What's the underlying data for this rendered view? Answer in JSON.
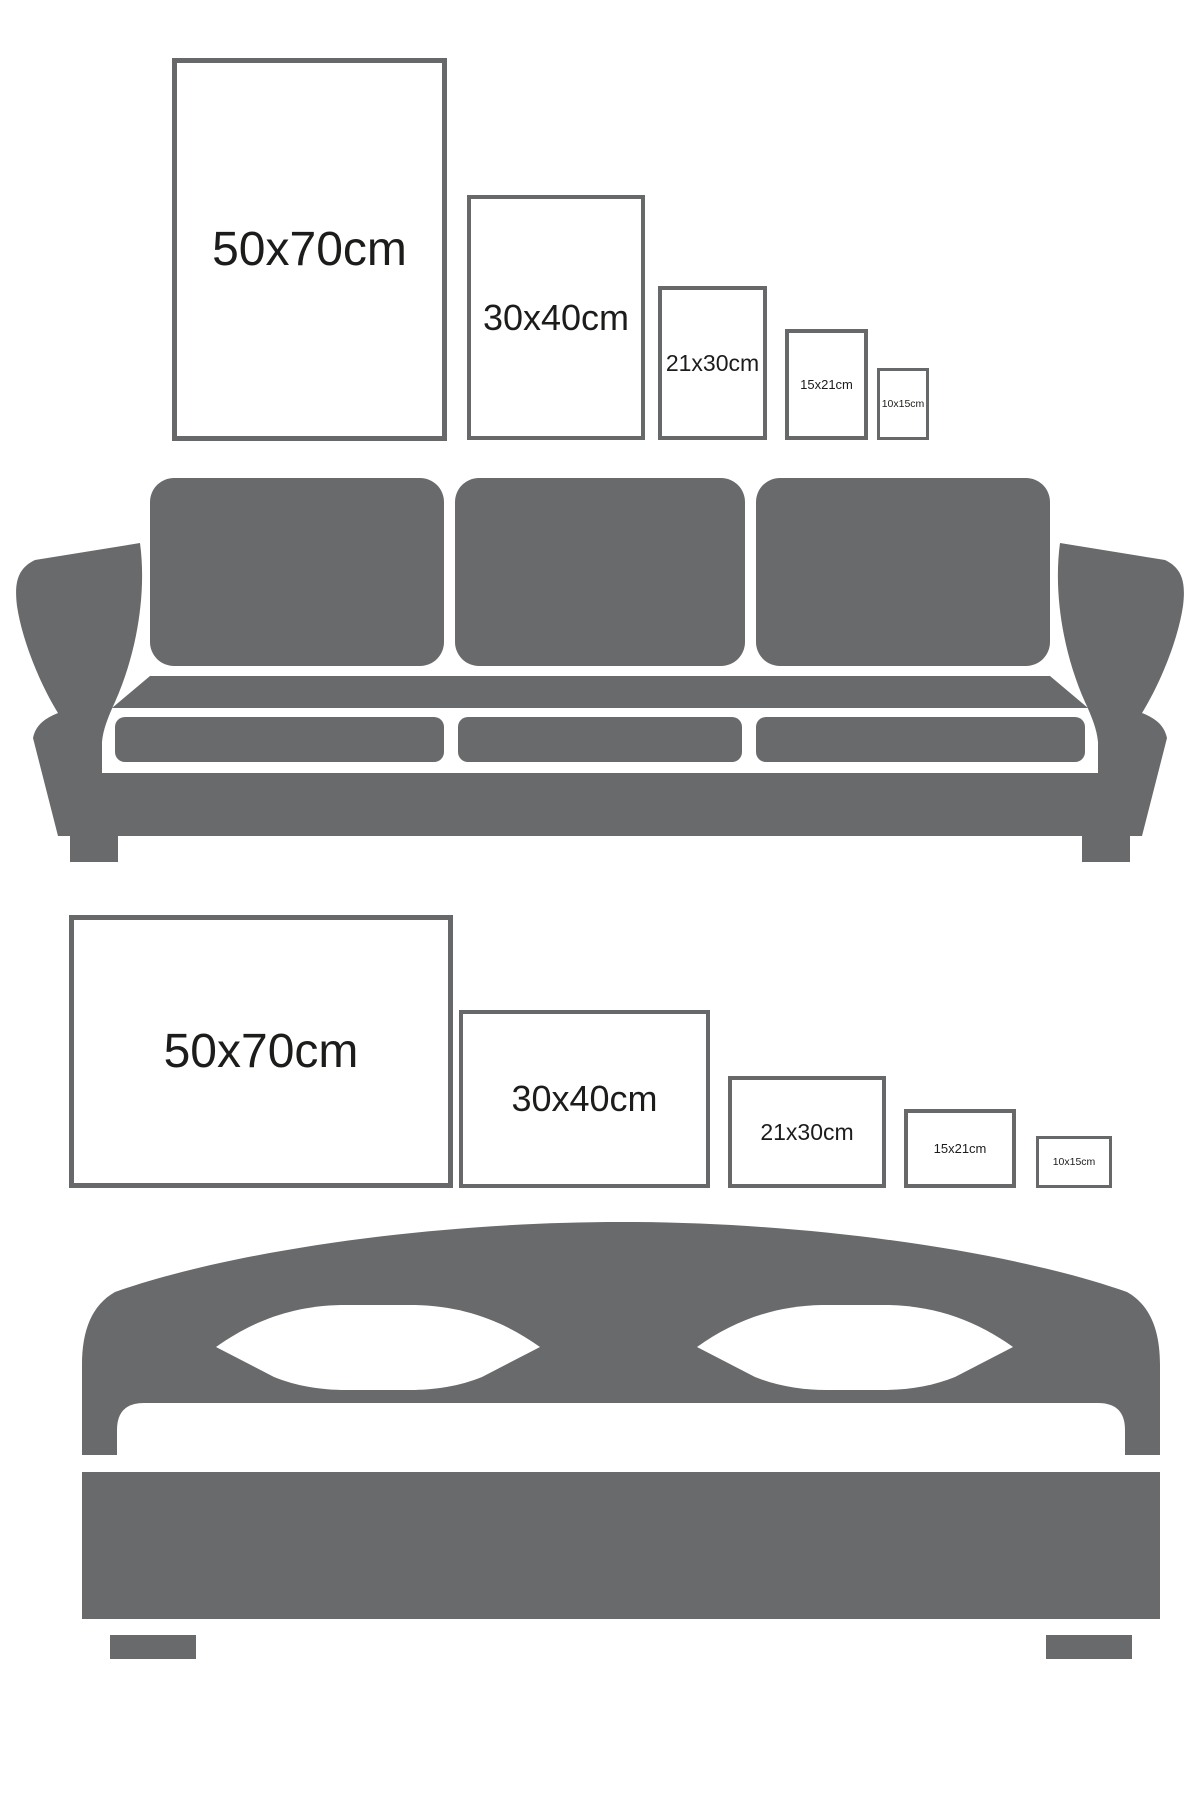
{
  "title": "Poster size comparison against sofa and bed",
  "colors": {
    "background": "#ffffff",
    "furniture_gray": "#696a6c",
    "frame_border_gray": "#67686a",
    "label_text": "#1c1c1a"
  },
  "top_section": {
    "name": "portrait frames above sofa",
    "frames": [
      {
        "label": "50x70cm",
        "orientation": "portrait"
      },
      {
        "label": "30x40cm",
        "orientation": "portrait"
      },
      {
        "label": "21x30cm",
        "orientation": "portrait"
      },
      {
        "label": "15x21cm",
        "orientation": "portrait"
      },
      {
        "label": "10x15cm",
        "orientation": "portrait"
      }
    ],
    "furniture_icon": "sofa-silhouette"
  },
  "bottom_section": {
    "name": "landscape frames above bed",
    "frames": [
      {
        "label": "50x70cm",
        "orientation": "landscape"
      },
      {
        "label": "30x40cm",
        "orientation": "landscape"
      },
      {
        "label": "21x30cm",
        "orientation": "landscape"
      },
      {
        "label": "15x21cm",
        "orientation": "landscape"
      },
      {
        "label": "10x15cm",
        "orientation": "landscape"
      }
    ],
    "furniture_icon": "bed-silhouette"
  }
}
